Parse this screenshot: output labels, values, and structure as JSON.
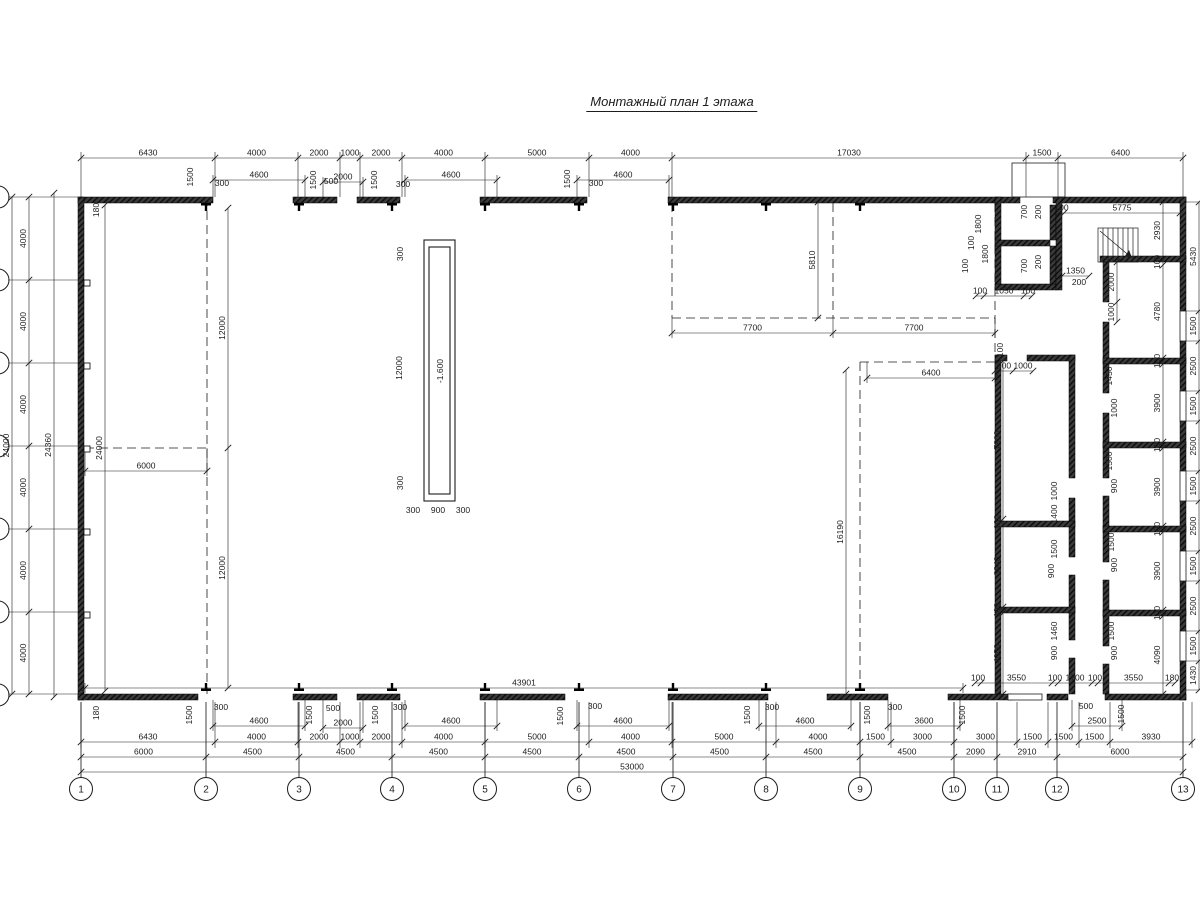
{
  "title": "Монтажный план 1 этажа",
  "pit_label": "-1.600",
  "colors": {
    "ink": "#1c1c1c",
    "wall": "#141414",
    "bg": "#ffffff"
  },
  "axis_bubbles": {
    "cy": 789,
    "r": 11.5,
    "bottom": [
      {
        "n": "1",
        "x": 81
      },
      {
        "n": "2",
        "x": 206
      },
      {
        "n": "3",
        "x": 299
      },
      {
        "n": "4",
        "x": 392
      },
      {
        "n": "5",
        "x": 485
      },
      {
        "n": "6",
        "x": 579
      },
      {
        "n": "7",
        "x": 673
      },
      {
        "n": "8",
        "x": 766
      },
      {
        "n": "9",
        "x": 860
      },
      {
        "n": "10",
        "x": 954
      },
      {
        "n": "11",
        "x": 997
      },
      {
        "n": "12",
        "x": 1057
      },
      {
        "n": "13",
        "x": 1183
      }
    ],
    "left_ys": [
      197,
      280,
      363,
      446,
      529,
      612,
      695
    ]
  },
  "drawing": {
    "walls": [
      [
        78,
        197,
        135,
        6
      ],
      [
        293,
        197,
        44,
        6
      ],
      [
        357,
        197,
        43,
        6
      ],
      [
        480,
        197,
        107,
        6
      ],
      [
        668,
        197,
        352,
        6
      ],
      [
        1053,
        197,
        133,
        6
      ],
      [
        78,
        197,
        6,
        503
      ],
      [
        78,
        694,
        120,
        6
      ],
      [
        293,
        694,
        44,
        6
      ],
      [
        357,
        694,
        43,
        6
      ],
      [
        480,
        694,
        85,
        6
      ],
      [
        668,
        694,
        100,
        6
      ],
      [
        827,
        694,
        61,
        6
      ],
      [
        948,
        694,
        64,
        6
      ],
      [
        1047,
        694,
        21,
        6
      ],
      [
        1105,
        694,
        81,
        6
      ],
      [
        1180,
        197,
        6,
        114
      ],
      [
        1180,
        341,
        6,
        50
      ],
      [
        1180,
        421,
        6,
        50
      ],
      [
        1180,
        501,
        6,
        50
      ],
      [
        1180,
        581,
        6,
        50
      ],
      [
        1180,
        661,
        6,
        39
      ],
      [
        995,
        197,
        6,
        93
      ],
      [
        995,
        240,
        55,
        6
      ],
      [
        995,
        284,
        61,
        6
      ],
      [
        1050,
        205,
        6,
        35
      ],
      [
        1050,
        246,
        6,
        38
      ],
      [
        1056,
        197,
        6,
        93
      ],
      [
        1100,
        256,
        86,
        6
      ],
      [
        995,
        355,
        6,
        339
      ],
      [
        995,
        355,
        12,
        6
      ],
      [
        1027,
        355,
        48,
        6
      ],
      [
        1069,
        355,
        6,
        123
      ],
      [
        1069,
        498,
        6,
        59
      ],
      [
        1069,
        575,
        6,
        65
      ],
      [
        1069,
        658,
        6,
        36
      ],
      [
        995,
        521,
        80,
        6
      ],
      [
        995,
        607,
        80,
        6
      ],
      [
        1103,
        262,
        6,
        40
      ],
      [
        1103,
        322,
        6,
        71
      ],
      [
        1103,
        413,
        6,
        65
      ],
      [
        1103,
        496,
        6,
        66
      ],
      [
        1103,
        580,
        6,
        66
      ],
      [
        1103,
        664,
        6,
        30
      ],
      [
        1103,
        358,
        83,
        6
      ],
      [
        1103,
        442,
        83,
        6
      ],
      [
        1103,
        526,
        83,
        6
      ],
      [
        1103,
        610,
        83,
        6
      ]
    ],
    "windows": [
      [
        1180,
        311,
        6,
        30
      ],
      [
        1180,
        391,
        6,
        30
      ],
      [
        1180,
        471,
        6,
        30
      ],
      [
        1180,
        551,
        6,
        30
      ],
      [
        1180,
        631,
        6,
        30
      ],
      [
        1008,
        694,
        34,
        6
      ]
    ],
    "pilasters": {
      "top_xs": [
        206,
        299,
        392,
        485,
        579,
        673,
        766,
        860
      ],
      "bottom_xs": [
        206,
        299,
        392,
        485,
        579,
        673,
        766,
        860
      ],
      "left_ys": [
        283,
        366,
        449,
        532,
        615
      ]
    },
    "dashed": [
      [
        207,
        197,
        207,
        694
      ],
      [
        85,
        448,
        207,
        448
      ],
      [
        672,
        203,
        672,
        318
      ],
      [
        833,
        203,
        833,
        318
      ],
      [
        995,
        203,
        995,
        355
      ],
      [
        672,
        318,
        995,
        318
      ],
      [
        860,
        362,
        860,
        690
      ],
      [
        860,
        362,
        995,
        362
      ]
    ],
    "ext_paths": [
      "M81 197V152M215 197V152M298 197V152M340 197V152M360 197V152M402 197V152M485 197V152M589 197V152M672 197V152M1026 197V152M1058 197V152M1183 197V152",
      "M213 197V175M305 197V175M323 197V177M363 197V177M405 197V175M497 197V175M577 197V175M669 197V175",
      "M81 702V748M215 702V748M298 702V748M340 702V748M360 702V748M402 702V748M485 702V748M589 702V748M672 702V748M776 702V748M860 702V748M891 702V748M954 702V748M1017 702V748M1048 702V748M1079 702V748M1110 702V748M1192 702V748",
      "M81 702V777M206 702V777M299 702V777M392 702V777M485 702V777M579 702V777M673 702V777M766 702V777M860 702V777M954 702V777M997 702V777M1057 702V777M1183 702V777",
      "M213 700V731M305 700V731M323 700V733M363 700V733M405 700V731M497 700V731M577 700V731M669 700V731M759 700V731M851 700V731M888 700V731M960 700V731M1072 700V731M1122 700V731",
      "M8 197H78M8 280H78M8 363H78M8 446H78M8 529H78M8 612H78M8 694H78",
      "M1186 202H1199M1186 311H1199M1186 341H1199M1186 391H1199M1186 421H1199M1186 471H1199M1186 501H1199M1186 551H1199M1186 581H1199M1186 631H1199M1186 661H1199M1186 690H1199",
      "M672 318V338M833 318V338M995 318V338M867 362V383M995 362V383M85 448V476M207 448V476M85 683V693M963 683V693"
    ],
    "chains_h": [
      {
        "y": 158,
        "pts": [
          81,
          215,
          298,
          340,
          360,
          402,
          485,
          589,
          672,
          1026,
          1058,
          1183
        ],
        "labels": [
          "6430",
          "4000",
          "2000",
          "1000",
          "2000",
          "4000",
          "5000",
          "4000",
          "17030",
          "1500",
          "6400"
        ]
      },
      {
        "y": 180,
        "pts": [
          213,
          305
        ],
        "labels": [
          "4600"
        ]
      },
      {
        "y": 182,
        "pts": [
          323,
          363
        ],
        "labels": [
          "2000"
        ]
      },
      {
        "y": 180,
        "pts": [
          405,
          497
        ],
        "labels": [
          "4600"
        ]
      },
      {
        "y": 180,
        "pts": [
          577,
          669
        ],
        "labels": [
          "4600"
        ]
      },
      {
        "y": 213,
        "pts": [
          1059,
          1064,
          1180
        ],
        "labels": [
          "100",
          "5775"
        ]
      },
      {
        "y": 296,
        "pts": [
          976,
          984,
          1024,
          1032
        ],
        "labels": [
          "100",
          "1050",
          "100"
        ]
      },
      {
        "y": 276,
        "pts": [
          1062,
          1089
        ],
        "labels": [
          "1350"
        ]
      },
      {
        "y": 333,
        "pts": [
          672,
          833,
          995
        ],
        "labels": [
          "7700",
          "7700"
        ]
      },
      {
        "y": 378,
        "pts": [
          867,
          995
        ],
        "labels": [
          "6400"
        ]
      },
      {
        "y": 371,
        "pts": [
          995,
          1013,
          1033
        ],
        "labels": [
          "900",
          "1000"
        ]
      },
      {
        "y": 471,
        "pts": [
          85,
          207
        ],
        "labels": [
          "6000"
        ]
      },
      {
        "y": 688,
        "pts": [
          85,
          963
        ],
        "labels": [
          "43901"
        ]
      },
      {
        "y": 683,
        "pts": [
          975,
          981,
          1052,
          1058,
          1092,
          1098,
          1169,
          1175
        ],
        "labels": [
          "100",
          "3550",
          "100",
          "1700",
          "100",
          "3550",
          "180"
        ]
      },
      {
        "y": 726,
        "pts": [
          213,
          305
        ],
        "labels": [
          "4600"
        ]
      },
      {
        "y": 728,
        "pts": [
          323,
          363
        ],
        "labels": [
          "2000"
        ]
      },
      {
        "y": 726,
        "pts": [
          405,
          497
        ],
        "labels": [
          "4600"
        ]
      },
      {
        "y": 726,
        "pts": [
          577,
          669
        ],
        "labels": [
          "4600"
        ]
      },
      {
        "y": 726,
        "pts": [
          759,
          851
        ],
        "labels": [
          "4600"
        ]
      },
      {
        "y": 726,
        "pts": [
          888,
          960
        ],
        "labels": [
          "3600"
        ]
      },
      {
        "y": 726,
        "pts": [
          1072,
          1122
        ],
        "labels": [
          "2500"
        ]
      },
      {
        "y": 742,
        "pts": [
          81,
          215,
          298,
          340,
          360,
          402,
          485,
          589,
          672,
          776,
          860,
          891,
          954,
          1017,
          1048,
          1079,
          1110,
          1192
        ],
        "labels": [
          "6430",
          "4000",
          "2000",
          "1000",
          "2000",
          "4000",
          "5000",
          "4000",
          "5000",
          "4000",
          "1500",
          "3000",
          "3000",
          "1500",
          "1500",
          "1500",
          "3930"
        ]
      },
      {
        "y": 757,
        "pts": [
          81,
          206,
          299,
          392,
          485,
          579,
          673,
          766,
          860,
          954,
          997,
          1057,
          1183
        ],
        "labels": [
          "6000",
          "4500",
          "4500",
          "4500",
          "4500",
          "4500",
          "4500",
          "4500",
          "4500",
          "2090",
          "2910",
          "6000"
        ]
      },
      {
        "y": 772,
        "pts": [
          81,
          1183
        ],
        "labels": [
          "53000"
        ]
      }
    ],
    "chains_v": [
      {
        "x": 12,
        "pts": [
          197,
          694
        ],
        "labels": [
          "24000"
        ]
      },
      {
        "x": 29,
        "pts": [
          197,
          280,
          363,
          446,
          529,
          612,
          694
        ],
        "labels": [
          "4000",
          "4000",
          "4000",
          "4000",
          "4000",
          "4000"
        ]
      },
      {
        "x": 54,
        "pts": [
          193,
          697
        ],
        "labels": [
          "24360"
        ]
      },
      {
        "x": 105,
        "pts": [
          205,
          691
        ],
        "labels": [
          "24000"
        ]
      },
      {
        "x": 228,
        "pts": [
          208,
          448,
          688
        ],
        "labels": [
          "12000",
          "12000"
        ]
      },
      {
        "x": 818,
        "pts": [
          202,
          318
        ],
        "labels": [
          "5810"
        ]
      },
      {
        "x": 846,
        "pts": [
          370,
          694
        ],
        "labels": [
          "16190"
        ]
      },
      {
        "x": 1199,
        "pts": [
          202,
          311,
          341,
          391,
          421,
          471,
          501,
          551,
          581,
          631,
          661,
          690
        ],
        "labels": [
          "5430",
          "1500",
          "2500",
          "1500",
          "2500",
          "1500",
          "2500",
          "1500",
          "2500",
          "1500",
          "1430"
        ]
      },
      {
        "x": 1163,
        "pts": [
          202,
          259,
          265,
          358,
          364,
          442,
          448,
          526,
          532,
          610,
          616,
          694
        ],
        "labels": [
          "2930",
          "100",
          "4780",
          "100",
          "3900",
          "100",
          "3900",
          "100",
          "3900",
          "100",
          "4090"
        ]
      },
      {
        "x": 1117,
        "pts": [
          262,
          302,
          322
        ],
        "labels": [
          "2000",
          "1000"
        ]
      },
      {
        "x": 1003,
        "pts": [
          361,
          519,
          525,
          607,
          613,
          694
        ],
        "labels": [
          "7900",
          "100",
          "3940",
          "100",
          "4050"
        ]
      }
    ],
    "labels": [
      {
        "t": "1500",
        "x": 193,
        "y": 177,
        "r": -90
      },
      {
        "t": "1500",
        "x": 316,
        "y": 180,
        "r": -90
      },
      {
        "t": "1500",
        "x": 377,
        "y": 180,
        "r": -90
      },
      {
        "t": "1500",
        "x": 570,
        "y": 179,
        "r": -90
      },
      {
        "t": "300",
        "x": 222,
        "y": 186
      },
      {
        "t": "500",
        "x": 331,
        "y": 184
      },
      {
        "t": "300",
        "x": 403,
        "y": 187
      },
      {
        "t": "300",
        "x": 596,
        "y": 186
      },
      {
        "t": "180",
        "x": 99,
        "y": 210,
        "r": -90
      },
      {
        "t": "180",
        "x": 99,
        "y": 713,
        "r": -90
      },
      {
        "t": "1500",
        "x": 192,
        "y": 715,
        "r": -90
      },
      {
        "t": "1500",
        "x": 312,
        "y": 715,
        "r": -90
      },
      {
        "t": "1500",
        "x": 378,
        "y": 715,
        "r": -90
      },
      {
        "t": "1500",
        "x": 563,
        "y": 716,
        "r": -90
      },
      {
        "t": "1500",
        "x": 750,
        "y": 715,
        "r": -90
      },
      {
        "t": "1500",
        "x": 870,
        "y": 715,
        "r": -90
      },
      {
        "t": "1500",
        "x": 965,
        "y": 715,
        "r": -90
      },
      {
        "t": "1500",
        "x": 1124,
        "y": 714,
        "r": -90
      },
      {
        "t": "300",
        "x": 221,
        "y": 710
      },
      {
        "t": "500",
        "x": 333,
        "y": 711
      },
      {
        "t": "300",
        "x": 400,
        "y": 710
      },
      {
        "t": "300",
        "x": 595,
        "y": 709
      },
      {
        "t": "300",
        "x": 772,
        "y": 710
      },
      {
        "t": "300",
        "x": 895,
        "y": 710
      },
      {
        "t": "500",
        "x": 1086,
        "y": 709
      },
      {
        "t": "1800",
        "x": 981,
        "y": 224,
        "r": -90
      },
      {
        "t": "100",
        "x": 974,
        "y": 243,
        "r": -90
      },
      {
        "t": "1800",
        "x": 988,
        "y": 254,
        "r": -90
      },
      {
        "t": "100",
        "x": 968,
        "y": 266,
        "r": -90
      },
      {
        "t": "700",
        "x": 1027,
        "y": 212,
        "r": -90
      },
      {
        "t": "200",
        "x": 1041,
        "y": 212,
        "r": -90
      },
      {
        "t": "700",
        "x": 1027,
        "y": 266,
        "r": -90
      },
      {
        "t": "200",
        "x": 1041,
        "y": 262,
        "r": -90
      },
      {
        "t": "200",
        "x": 1079,
        "y": 285
      },
      {
        "t": "100",
        "x": 1003,
        "y": 350,
        "r": -90
      },
      {
        "t": "1000",
        "x": 1057,
        "y": 491,
        "r": -90
      },
      {
        "t": "1400",
        "x": 1057,
        "y": 514,
        "r": -90
      },
      {
        "t": "1500",
        "x": 1057,
        "y": 549,
        "r": -90
      },
      {
        "t": "900",
        "x": 1054,
        "y": 571,
        "r": -90
      },
      {
        "t": "1460",
        "x": 1057,
        "y": 631,
        "r": -90
      },
      {
        "t": "900",
        "x": 1057,
        "y": 653,
        "r": -90
      },
      {
        "t": "1450",
        "x": 1112,
        "y": 376,
        "r": -90
      },
      {
        "t": "1000",
        "x": 1117,
        "y": 408,
        "r": -90
      },
      {
        "t": "1500",
        "x": 1112,
        "y": 461,
        "r": -90
      },
      {
        "t": "900",
        "x": 1117,
        "y": 486,
        "r": -90
      },
      {
        "t": "1500",
        "x": 1114,
        "y": 542,
        "r": -90
      },
      {
        "t": "900",
        "x": 1117,
        "y": 565,
        "r": -90
      },
      {
        "t": "1500",
        "x": 1114,
        "y": 631,
        "r": -90
      },
      {
        "t": "900",
        "x": 1117,
        "y": 653,
        "r": -90
      },
      {
        "t": "300",
        "x": 403,
        "y": 254,
        "r": -90
      },
      {
        "t": "12000",
        "x": 402,
        "y": 368,
        "r": -90
      },
      {
        "t": "300",
        "x": 403,
        "y": 483,
        "r": -90
      },
      {
        "t": "300",
        "x": 413,
        "y": 513
      },
      {
        "t": "900",
        "x": 438,
        "y": 513
      },
      {
        "t": "300",
        "x": 463,
        "y": 513
      },
      {
        "t": "-1.600",
        "x": 443,
        "y": 371,
        "r": -90
      }
    ],
    "stairs": {
      "x": 1098,
      "y": 228,
      "w": 40,
      "h": 34,
      "steps": 8
    },
    "canopy": {
      "x": 1012,
      "y": 163,
      "w": 53,
      "h": 34
    },
    "pit_rects": [
      [
        424,
        240,
        31,
        261
      ],
      [
        429,
        247,
        21,
        247
      ]
    ]
  }
}
